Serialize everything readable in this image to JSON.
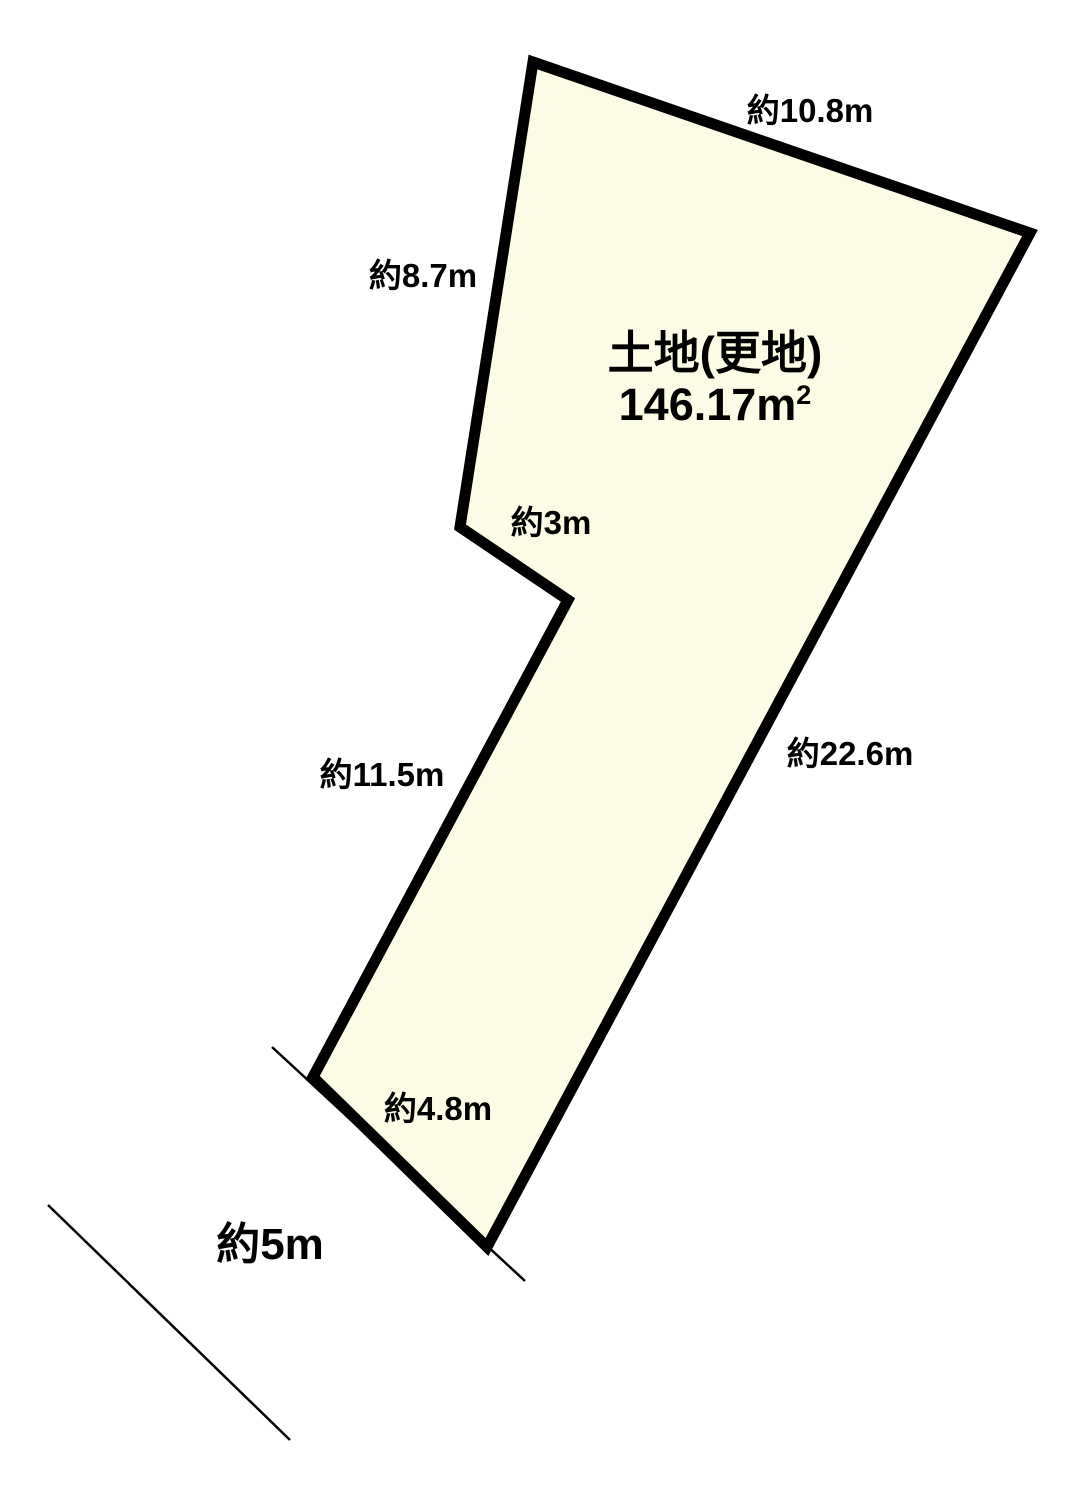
{
  "parcel": {
    "title": "土地(更地)",
    "area_value": "146.17m",
    "area_exponent": "2"
  },
  "dimensions": {
    "top_edge": "約10.8m",
    "upper_left_edge": "約8.7m",
    "notch_edge": "約3m",
    "lower_left_edge": "約11.5m",
    "right_edge": "約22.6m",
    "bottom_edge": "約4.8m",
    "road_width": "約5m"
  },
  "colors": {
    "parcel_fill": "#FCFCE6",
    "outline": "#000000",
    "background": "#FFFFFF"
  }
}
